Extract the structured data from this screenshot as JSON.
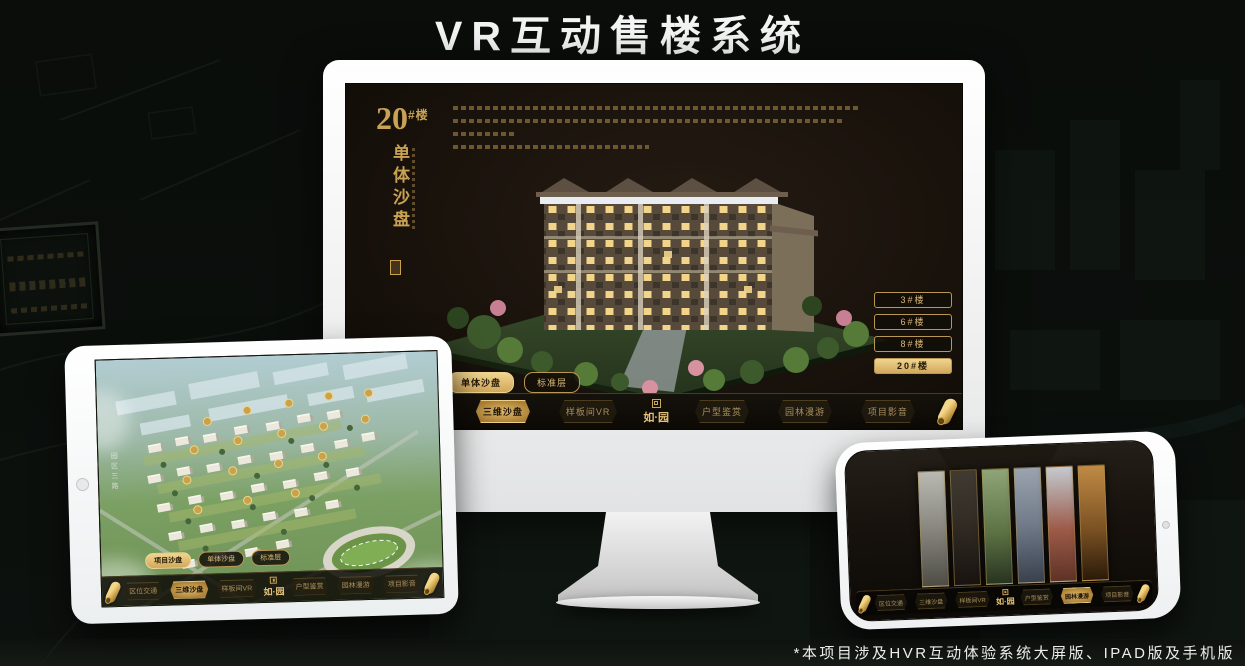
{
  "page": {
    "title": "VR互动售楼系统",
    "footnote": "*本项目涉及HVR互动体验系统大屏版、IPAD版及手机版"
  },
  "colors": {
    "gold": "#c9a254",
    "gold_bright": "#efd58f",
    "screen_bg": "#16100a"
  },
  "monitor": {
    "device": "desktop-large-screen",
    "screen": {
      "building_number": "20",
      "building_number_suffix": "#楼",
      "section_title_vertical": "单体沙盘",
      "floor_buttons": [
        {
          "label": "3#楼",
          "active": false
        },
        {
          "label": "6#楼",
          "active": false
        },
        {
          "label": "8#楼",
          "active": false
        },
        {
          "label": "20#楼",
          "active": true
        }
      ],
      "tabs": [
        {
          "label": "项目沙盘",
          "active": false
        },
        {
          "label": "单体沙盘",
          "active": true
        },
        {
          "label": "标准层",
          "active": false
        }
      ],
      "nav": {
        "items": [
          {
            "label": "区位交通",
            "active": false
          },
          {
            "label": "三维沙盘",
            "active": true
          },
          {
            "label": "样板间VR",
            "active": false
          },
          {
            "label": "户型鉴赏",
            "active": false
          },
          {
            "label": "园林漫游",
            "active": false
          },
          {
            "label": "项目影音",
            "active": false
          }
        ],
        "logo": "如·园"
      }
    }
  },
  "tablet": {
    "device": "ipad",
    "road_label": "园区三路",
    "tabs": [
      {
        "label": "项目沙盘",
        "active": true
      },
      {
        "label": "单体沙盘",
        "active": false
      },
      {
        "label": "标准层",
        "active": false
      }
    ],
    "nav": {
      "items": [
        {
          "label": "区位交通",
          "active": false
        },
        {
          "label": "三维沙盘",
          "active": true
        },
        {
          "label": "样板间VR",
          "active": false
        },
        {
          "label": "户型鉴赏",
          "active": false
        },
        {
          "label": "园林漫游",
          "active": false
        },
        {
          "label": "项目影音",
          "active": false
        }
      ],
      "logo": "如·园"
    }
  },
  "phone": {
    "device": "mobile",
    "nav": {
      "items": [
        {
          "label": "区位交通",
          "active": false
        },
        {
          "label": "三维沙盘",
          "active": false
        },
        {
          "label": "样板间VR",
          "active": false
        },
        {
          "label": "户型鉴赏",
          "active": false
        },
        {
          "label": "园林漫游",
          "active": true
        },
        {
          "label": "项目影音",
          "active": false
        }
      ],
      "logo": "如·园"
    }
  }
}
